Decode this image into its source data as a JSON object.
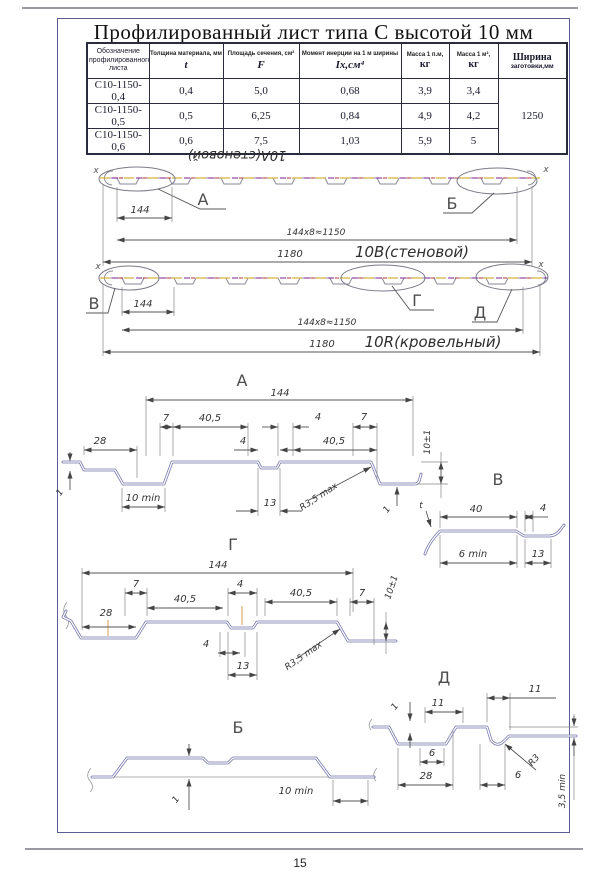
{
  "page": {
    "number": "15",
    "title": "Профилированный лист типа С высотой 10 мм"
  },
  "table": {
    "headers": {
      "col1": "Обозначение профилированного листа",
      "col2_top": "Толщина материала, мм",
      "col2_sym": "t",
      "col3_top": "Площадь сечения, см²",
      "col3_sym": "F",
      "col4_top": "Момент инерции на 1 м ширины",
      "col4_sym": "Iх,см⁴",
      "col5_top": "Масса 1 п.м,",
      "col5_sym": "кг",
      "col6_top": "Масса 1 м²,",
      "col6_sym": "кг",
      "col7_top": "Ширина",
      "col7_bottom": "заготовки,мм"
    },
    "rows": [
      {
        "name": "С10-1150-0,4",
        "t": "0,4",
        "f": "5,0",
        "i": "0,68",
        "m_pm": "3,9",
        "m_m2": "3,4"
      },
      {
        "name": "С10-1150-0,5",
        "t": "0,5",
        "f": "6,25",
        "i": "0,84",
        "m_pm": "4,9",
        "m_m2": "4,2"
      },
      {
        "name": "С10-1150-0,6",
        "t": "0,6",
        "f": "7,5",
        "i": "1,03",
        "m_pm": "5,9",
        "m_m2": "5"
      }
    ],
    "blank_width": "1250"
  },
  "labels": {
    "a": "А",
    "b": "Б",
    "v": "В",
    "g": "Г",
    "d": "Д",
    "x_axis": "х",
    "wall_flipped": "10А(стеновой)",
    "wall": "10В(стеновой)",
    "roof": "10R(кровельный)"
  },
  "dims": {
    "d144": "144",
    "d1150": "144х8≈1150",
    "d1180": "1180",
    "d7": "7",
    "d405": "40,5",
    "d4": "4",
    "d28": "28",
    "d13": "13",
    "d10min": "10 min",
    "d6min": "6 min",
    "d10pm": "10±1",
    "d1": "1",
    "d40": "40",
    "d11": "11",
    "d6": "6",
    "d35min": "3,5 min",
    "r35": "R3,5 max",
    "r3": "R3",
    "t": "t"
  }
}
